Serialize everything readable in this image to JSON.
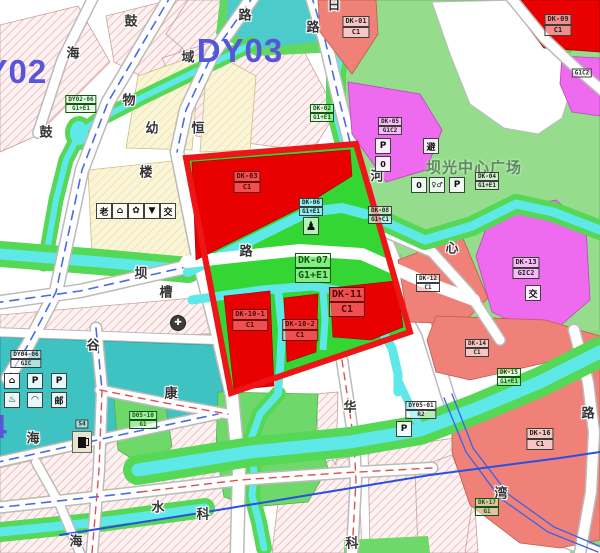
{
  "districts": {
    "dy02": "DY02",
    "dy03": "DY03",
    "dy04_digit": "4"
  },
  "plaza": {
    "name": "坝光中心广场"
  },
  "parcels": {
    "dk01": {
      "code": "DK-01",
      "use": "C1"
    },
    "dk02": {
      "code": "DK-02",
      "use": "G1+E1"
    },
    "dk03": {
      "code": "DK-03",
      "use": "C1"
    },
    "dk04": {
      "code": "DK-04",
      "use": "G1+E1"
    },
    "dk05": {
      "code": "DK-05",
      "use": "G1C2"
    },
    "dk06": {
      "code": "DK-06",
      "use": "G1+E1"
    },
    "dk07": {
      "code": "DK-07",
      "use": "G1+E1"
    },
    "dk08": {
      "code": "DK-08",
      "use": "G1+C1"
    },
    "dk09": {
      "code": "DK-09",
      "use": "C1"
    },
    "dk10_1": {
      "code": "DK-10-1",
      "use": "C1"
    },
    "dk10_2": {
      "code": "DK-10-2",
      "use": "C1"
    },
    "dk11": {
      "code": "DK-11",
      "use": "C1"
    },
    "dk12": {
      "code": "DK-12",
      "use": "C1"
    },
    "dk13": {
      "code": "DK-13",
      "use": "GIC2"
    },
    "dk14": {
      "code": "DK-14",
      "use": "C1"
    },
    "dk15": {
      "code": "DK-15",
      "use": "G1+E1"
    },
    "dk16": {
      "code": "DK-16",
      "use": "C1"
    },
    "dk17": {
      "code": "DK-17",
      "use": "G1"
    },
    "d05_10": {
      "code": "D05-10",
      "use": "G1"
    },
    "dy04_06": {
      "code": "DY04-06",
      "use": "GIC"
    },
    "dy05_01": {
      "code": "DY05-01",
      "use": "R2"
    },
    "dy02_06": {
      "code": "DY02-06",
      "use": "G1+E1"
    },
    "tr_magenta": {
      "use": "G1C2"
    },
    "station": {
      "code": "S4"
    }
  },
  "road_names": {
    "gu1": "鼓",
    "hai1": "海",
    "yu": "域",
    "wu": "物",
    "lou": "楼",
    "ba": "坝",
    "cao": "槽",
    "gu2": "鼓",
    "gu3": "谷",
    "kang": "康",
    "hai2": "海",
    "hai3": "海",
    "shui": "水",
    "ke1": "科",
    "hua": "华",
    "ke2": "科",
    "wan": "湾",
    "lu1": "路",
    "lu2": "路",
    "lu3": "路",
    "lu4": "路",
    "ri": "日",
    "he": "河",
    "xin": "心"
  },
  "area_names": {
    "you": "幼",
    "heng": "恒"
  },
  "icons": {
    "parking": "P",
    "ev": "P",
    "post": "邮",
    "shelter": "避",
    "toilet": "♀♂",
    "booth": "0",
    "statue": "♟",
    "cross": "✚",
    "elderly": "老",
    "home": "⌂",
    "garden": "✿",
    "market": "▼",
    "transit": "交",
    "dome": "◠",
    "spring": "♨"
  },
  "colors": {
    "selection_boundary": "#ed1515",
    "commercial_red": "#e90000",
    "commercial_salmon": "#ef8178",
    "mixed_magenta": "#ee6aee",
    "park_green": "#95dc8d",
    "strip_green": "#4fd84f",
    "block_green": "#33d633",
    "water_cyan": "#5fe8e8",
    "pond_teal": "#4ccbcb",
    "facility_teal": "#3fc2c2",
    "residential_hatch_pink": "#eda8a8",
    "public_yellow": "#faf5d8",
    "centerline_blue": "#4a6ae8",
    "centerline_red": "#e05050",
    "district_blue": "#5656d8"
  }
}
